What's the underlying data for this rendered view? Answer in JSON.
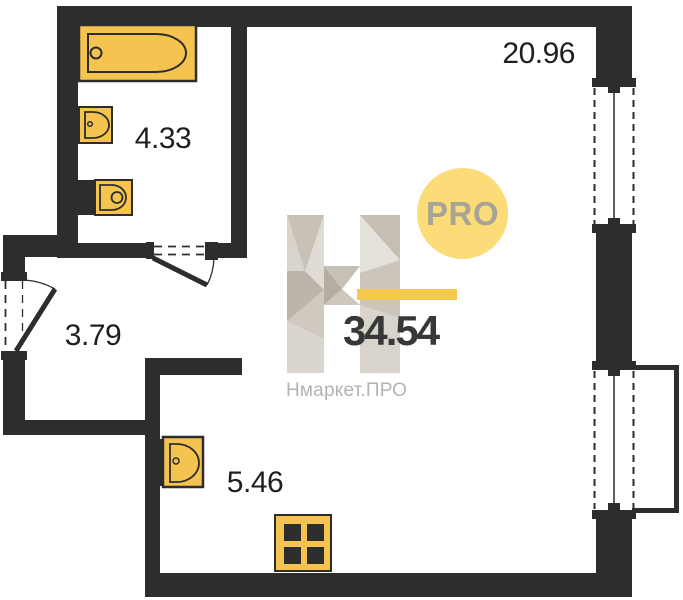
{
  "plan": {
    "total_area": "34.54",
    "rooms": [
      {
        "id": "living-room",
        "area": "20.96"
      },
      {
        "id": "bathroom",
        "area": "4.33"
      },
      {
        "id": "hallway",
        "area": "3.79"
      },
      {
        "id": "kitchen",
        "area": "5.46"
      }
    ]
  },
  "watermark": {
    "logo_letter": "H",
    "badge_label": "PRO",
    "brand_name": "Нмаркет.ПРО"
  },
  "colors": {
    "wall": "#2d2d2d",
    "fixture_yellow": "#f5c450",
    "badge_yellow": "#fbdc78",
    "accent_bar_yellow": "#f5c94e",
    "total_text": "#383838",
    "brand_gray": "#b3b3b3"
  }
}
